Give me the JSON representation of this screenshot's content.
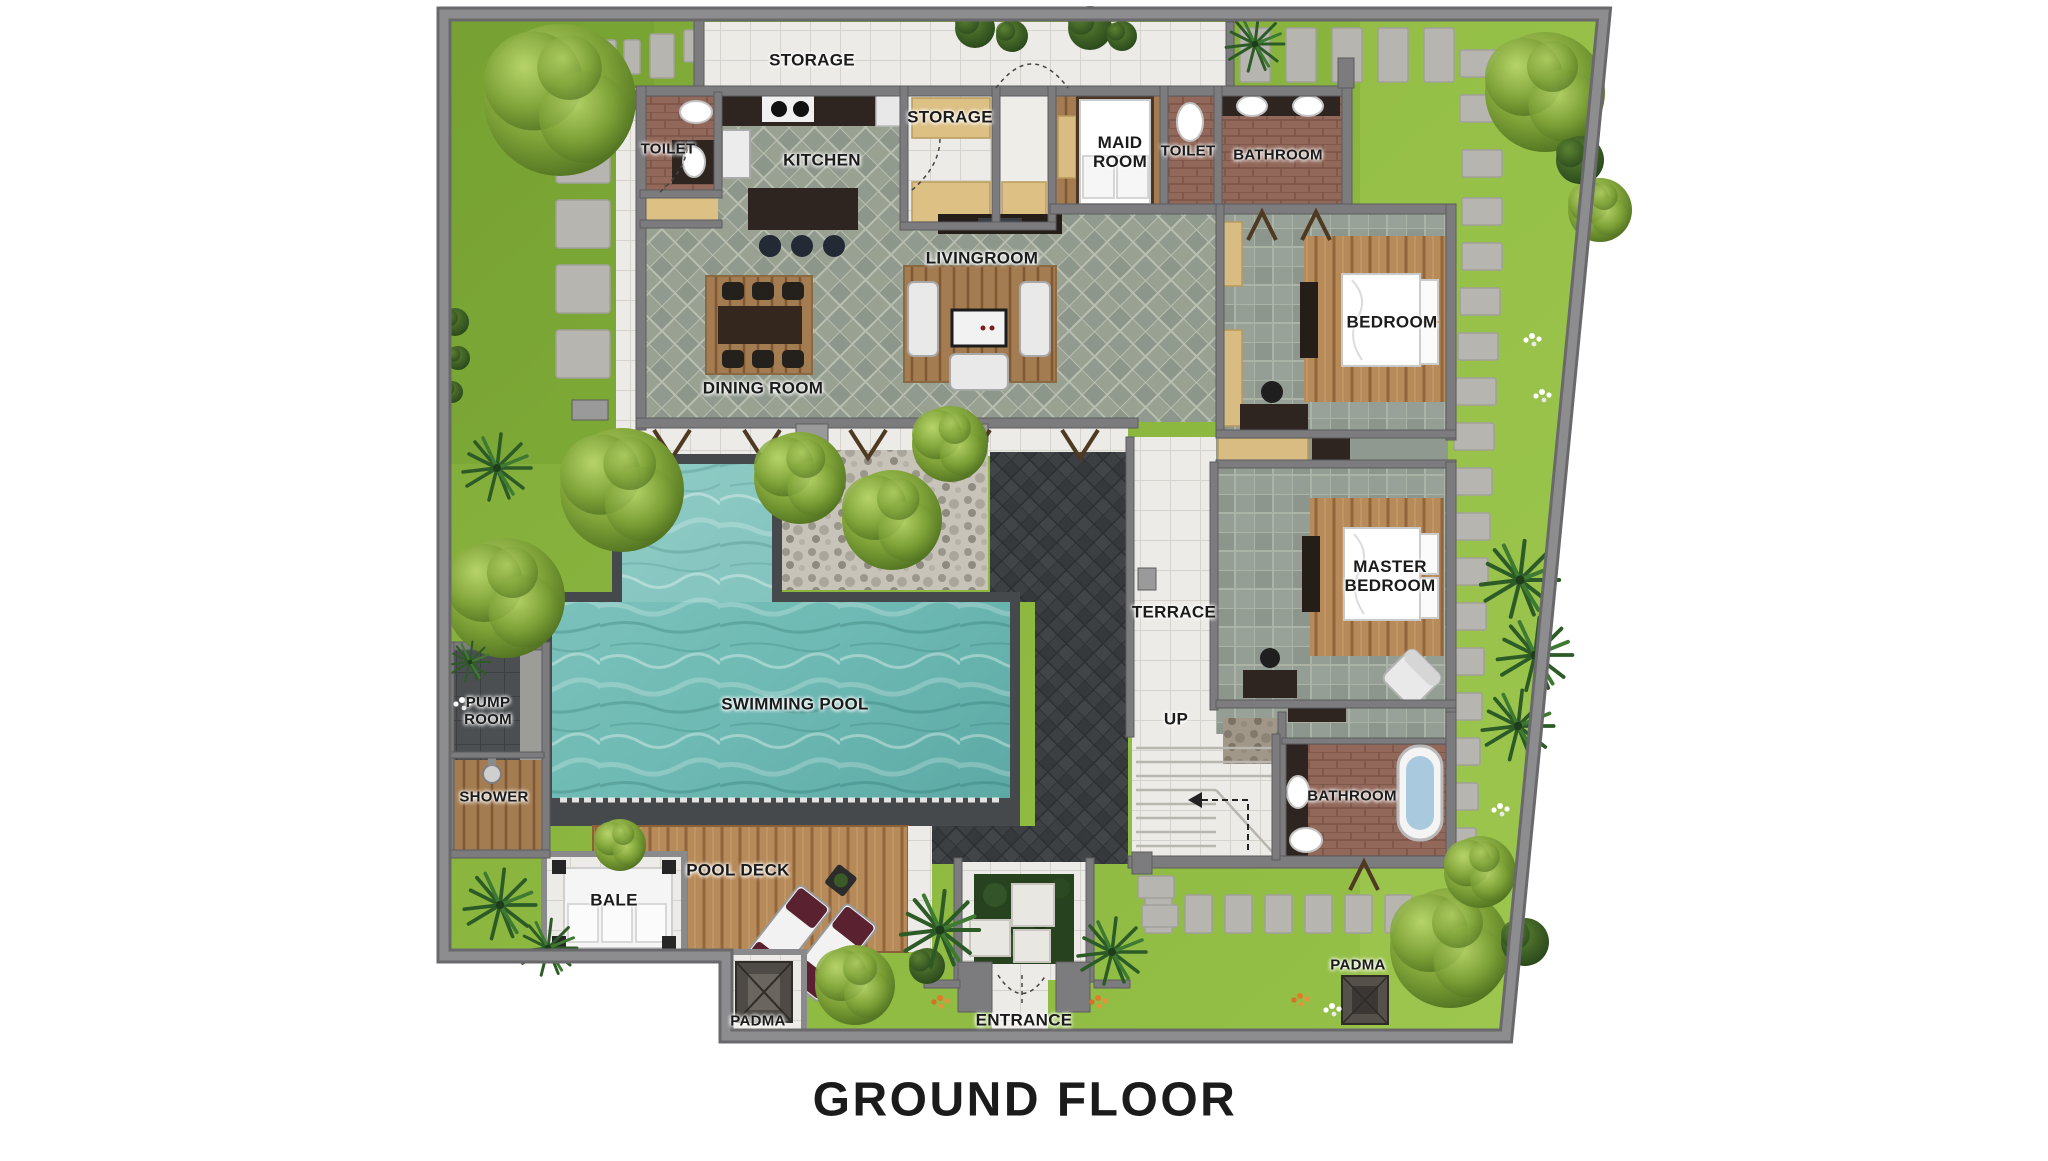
{
  "title": "GROUND FLOOR",
  "rooms": {
    "storage_top": "STORAGE",
    "toilet_top": "TOILET",
    "kitchen": "KITCHEN",
    "storage_small": "STORAGE",
    "maid_room": "MAID ROOM",
    "toilet_2": "TOILET",
    "bathroom_top": "BATHROOM",
    "bedroom": "BEDROOM",
    "livingroom": "LIVINGROOM",
    "dining_room": "DINING ROOM",
    "terrace": "TERRACE",
    "master_bedroom": "MASTER BEDROOM",
    "swimming_pool": "SWIMMING POOL",
    "pump_room": "PUMP ROOM",
    "shower": "SHOWER",
    "pool_deck": "POOL DECK",
    "bale": "BALE",
    "up": "UP",
    "bathroom_bottom": "BATHROOM",
    "padma_left": "PADMA",
    "entrance": "ENTRANCE",
    "padma_right": "PADMA"
  },
  "colors": {
    "bg": "#ffffff",
    "label": "#1b1b1b",
    "grass": "#87b13d",
    "water": "#6fbab4",
    "wood": "#b68a59",
    "wall": "#7c7c7f",
    "tile_white": "#edebe7",
    "dark_court": "#3c4042"
  }
}
